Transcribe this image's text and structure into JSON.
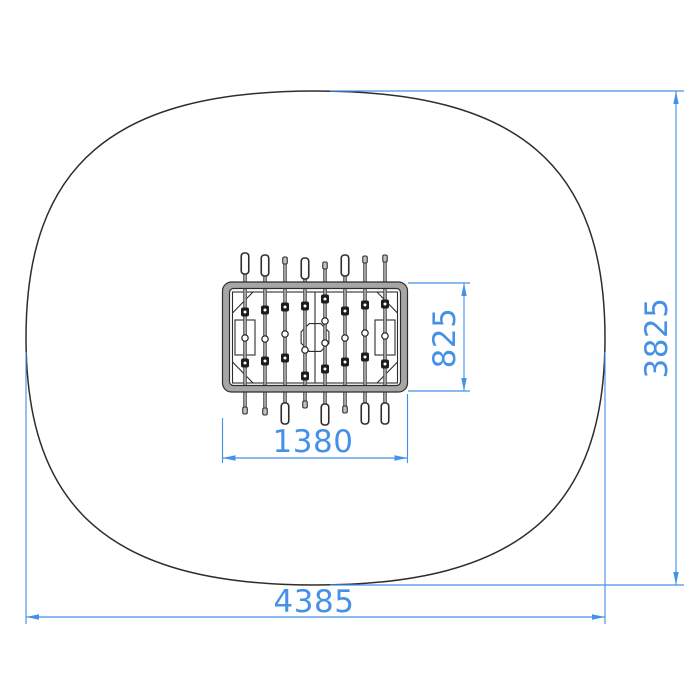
{
  "meta": {
    "type": "technical-drawing-plan-view",
    "subject": "table-football-with-safety-zone",
    "units": "mm"
  },
  "colors": {
    "dimension": "#4691e8",
    "outline": "#2d2d2d",
    "frame_fill": "#a6a6a6",
    "rod": "#9f9f9f",
    "rod_dark": "#4d4d4d",
    "player": "#1c1c1c",
    "background": "#ffffff"
  },
  "safety_zone": {
    "shape": "squircle",
    "x": 26,
    "y": 91,
    "width": 579,
    "height": 494,
    "squareness": 0.7
  },
  "table": {
    "frame": {
      "x": 222.5,
      "y": 282,
      "width": 185,
      "height": 110,
      "thickness": 7,
      "outer_radius": 9,
      "inner_radius": 4
    },
    "field": {
      "x": 232.5,
      "y": 292,
      "width": 165,
      "height": 91
    },
    "center_line_x": 315,
    "center_circle": {
      "cx": 315,
      "cy": 337.5,
      "r": 15,
      "sides": 8
    },
    "goal_boxes": [
      {
        "x": 235,
        "y": 320,
        "width": 20,
        "height": 35
      },
      {
        "x": 375,
        "y": 320,
        "width": 20,
        "height": 35
      }
    ],
    "corner_diagonals": [
      [
        232.5,
        313,
        253,
        292
      ],
      [
        397.5,
        313,
        377,
        292
      ],
      [
        232.5,
        362,
        253,
        383
      ],
      [
        397.5,
        362,
        377,
        383
      ]
    ]
  },
  "rods": [
    {
      "x": 245,
      "handle": "top",
      "handle_y": 253,
      "tip_y": 414,
      "players": [
        312,
        363
      ],
      "bearings": [
        338
      ]
    },
    {
      "x": 265,
      "handle": "top",
      "handle_y": 255,
      "tip_y": 415,
      "players": [
        310,
        361
      ],
      "bearings": [
        339
      ]
    },
    {
      "x": 285,
      "handle": "bottom",
      "handle_y": 403,
      "tip_y": 257,
      "players": [
        307,
        358
      ],
      "bearings": [
        334
      ]
    },
    {
      "x": 305,
      "handle": "top",
      "handle_y": 258,
      "tip_y": 408,
      "players": [
        306,
        376
      ],
      "bearings": [
        350
      ]
    },
    {
      "x": 325,
      "handle": "bottom",
      "handle_y": 404,
      "tip_y": 262,
      "players": [
        299,
        369
      ],
      "bearings": [
        321,
        343
      ]
    },
    {
      "x": 345,
      "handle": "top",
      "handle_y": 255,
      "tip_y": 413,
      "players": [
        311,
        362
      ],
      "bearings": [
        338
      ]
    },
    {
      "x": 365,
      "handle": "bottom",
      "handle_y": 403,
      "tip_y": 256,
      "players": [
        305,
        357
      ],
      "bearings": [
        333
      ]
    },
    {
      "x": 385,
      "handle": "bottom",
      "handle_y": 403,
      "tip_y": 255,
      "players": [
        304,
        364
      ],
      "bearings": [
        336
      ]
    }
  ],
  "dimensions": [
    {
      "id": "table-width",
      "label": "1380",
      "orientation": "horizontal",
      "line": [
        222.5,
        458,
        407.5,
        458
      ],
      "ext": [
        [
          222.5,
          418,
          222.5,
          463
        ],
        [
          407.5,
          394,
          407.5,
          463
        ]
      ],
      "label_pos": [
        313,
        452
      ]
    },
    {
      "id": "table-depth",
      "label": "825",
      "orientation": "vertical",
      "line": [
        464,
        283,
        464,
        391
      ],
      "ext": [
        [
          408,
          283,
          470,
          283
        ],
        [
          408,
          391,
          470,
          391
        ]
      ],
      "label_pos": [
        455,
        338
      ]
    },
    {
      "id": "zone-width",
      "label": "4385",
      "orientation": "horizontal",
      "line": [
        26,
        617,
        605,
        617
      ],
      "ext": [
        [
          26,
          352,
          26,
          624
        ],
        [
          605,
          352,
          605,
          624
        ]
      ],
      "label_pos": [
        314,
        612
      ]
    },
    {
      "id": "zone-height",
      "label": "3825",
      "orientation": "vertical",
      "line": [
        676,
        91,
        676,
        585
      ],
      "ext": [
        [
          330,
          91,
          684,
          91
        ],
        [
          330,
          585,
          684,
          585
        ]
      ],
      "label_pos": [
        667,
        338
      ]
    }
  ]
}
